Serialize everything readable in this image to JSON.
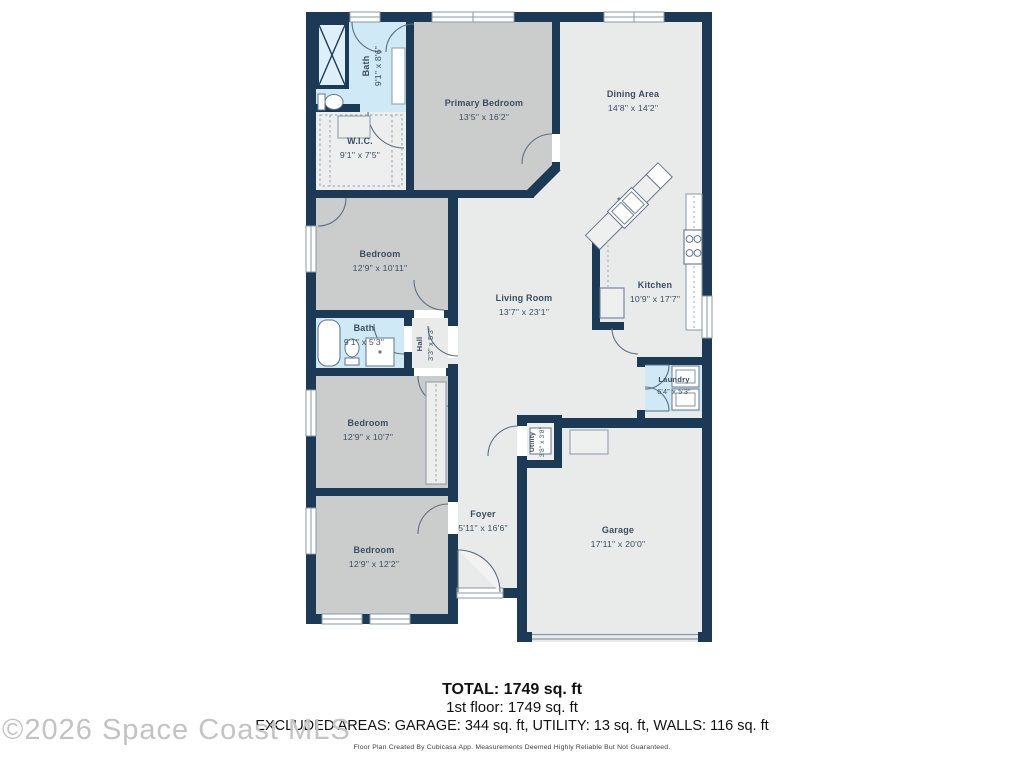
{
  "watermark": "©2026 Space Coast MLS",
  "summary": {
    "total": "TOTAL: 1749 sq. ft",
    "floor": "1st floor: 1749 sq. ft",
    "excluded": "EXCLUDED AREAS: GARAGE: 344 sq. ft, UTILITY: 13 sq. ft, WALLS: 116 sq. ft",
    "disclaimer": "Floor Plan Created By Cubicasa App. Measurements Deemed Highly Reliable But Not Guaranteed."
  },
  "rooms": {
    "bath1": {
      "name": "Bath",
      "dims": "9'1\" x 8'6\""
    },
    "wic": {
      "name": "W.I.C.",
      "dims": "9'1\" x 7'5\""
    },
    "primary": {
      "name": "Primary Bedroom",
      "dims": "13'5\" x 16'2\""
    },
    "dining": {
      "name": "Dining Area",
      "dims": "14'8\" x 14'2\""
    },
    "bedroom2": {
      "name": "Bedroom",
      "dims": "12'9\" x 10'11\""
    },
    "living": {
      "name": "Living Room",
      "dims": "13'7\" x 23'1\""
    },
    "kitchen": {
      "name": "Kitchen",
      "dims": "10'9\" x 17'7\""
    },
    "bath2": {
      "name": "Bath",
      "dims": "9'1\" x 5'3\""
    },
    "hall": {
      "name": "Hall",
      "dims": "3'3\" x 5'3\""
    },
    "laundry": {
      "name": "Laundry",
      "dims": "6'4\" x 5'3\""
    },
    "bedroom3": {
      "name": "Bedroom",
      "dims": "12'9\" x 10'7\""
    },
    "utility": {
      "name": "Utility",
      "dims": "3'8\" x 3'8\""
    },
    "bedroom4": {
      "name": "Bedroom",
      "dims": "12'9\" x 12'2\""
    },
    "foyer": {
      "name": "Foyer",
      "dims": "5'11\" x 16'6\""
    },
    "garage": {
      "name": "Garage",
      "dims": "17'11\" x 20'0\""
    }
  },
  "colors": {
    "wall": "#1c3a55",
    "room_gray": "#cbcdcc",
    "room_light": "#e9ebeb",
    "room_blue": "#cfe9f6",
    "label": "#3a4d60"
  }
}
